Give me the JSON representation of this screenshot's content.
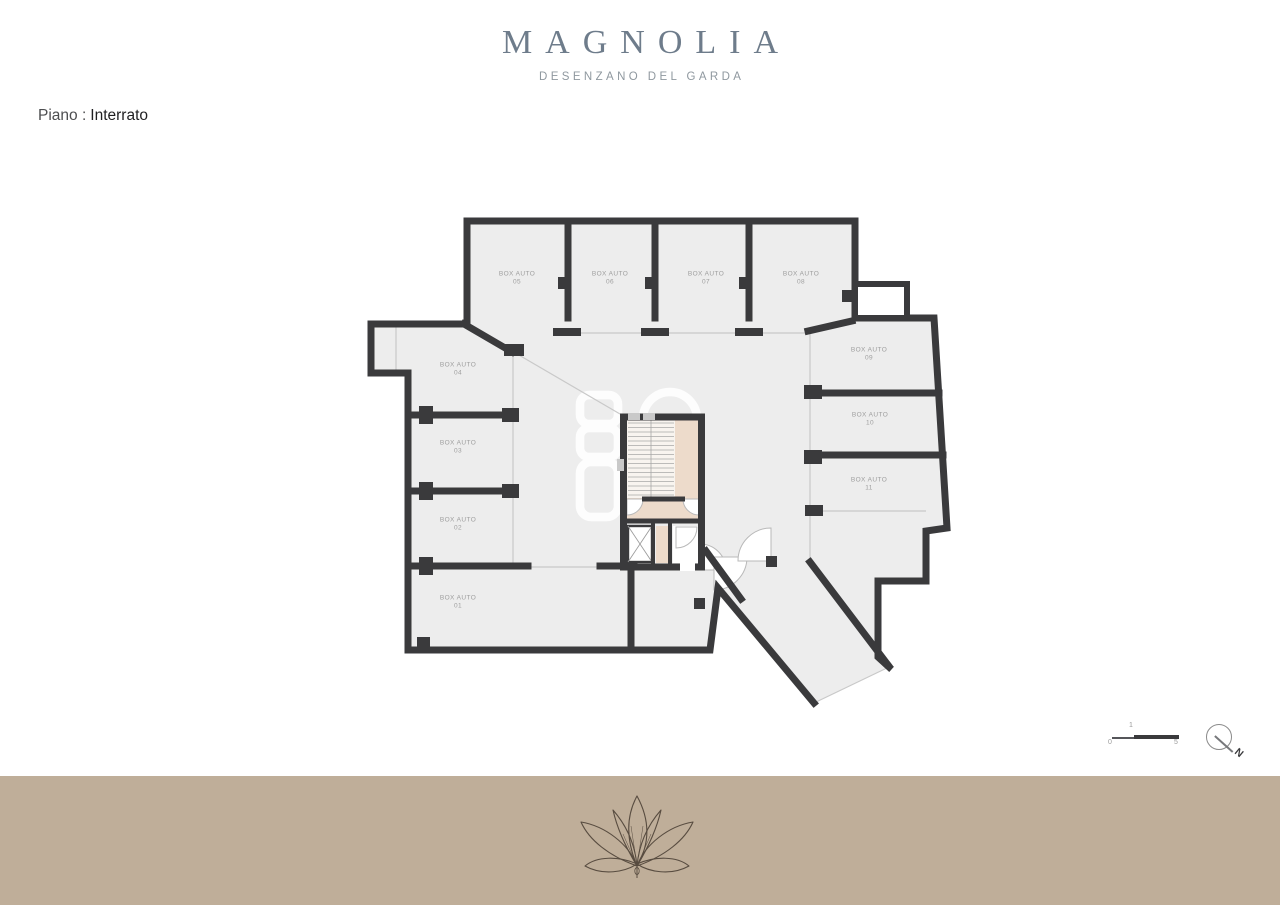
{
  "brand": {
    "title": "MAGNOLIA",
    "subtitle": "DESENZANO DEL GARDA"
  },
  "floor": {
    "prefix": "Piano :",
    "name": "Interrato"
  },
  "plan": {
    "unit_label": "BOX AUTO",
    "boxes": [
      {
        "name": "BOX AUTO",
        "num": "01"
      },
      {
        "name": "BOX AUTO",
        "num": "02"
      },
      {
        "name": "BOX AUTO",
        "num": "03"
      },
      {
        "name": "BOX AUTO",
        "num": "04"
      },
      {
        "name": "BOX AUTO",
        "num": "05"
      },
      {
        "name": "BOX AUTO",
        "num": "06"
      },
      {
        "name": "BOX AUTO",
        "num": "07"
      },
      {
        "name": "BOX AUTO",
        "num": "08"
      },
      {
        "name": "BOX AUTO",
        "num": "09"
      },
      {
        "name": "BOX AUTO",
        "num": "10"
      },
      {
        "name": "BOX AUTO",
        "num": "11"
      }
    ]
  },
  "legend": {
    "scale": {
      "zero": "0",
      "one": "1",
      "five": "5"
    },
    "compass_label": "N"
  },
  "colors": {
    "wall": "#3a3a3c",
    "floor": "#ededed",
    "stair_fill": "#f8f4ef",
    "beige": "#eddbcb",
    "band": "#bfae99",
    "title": "#6e7c8b",
    "label_gray": "#9e9e9e"
  }
}
